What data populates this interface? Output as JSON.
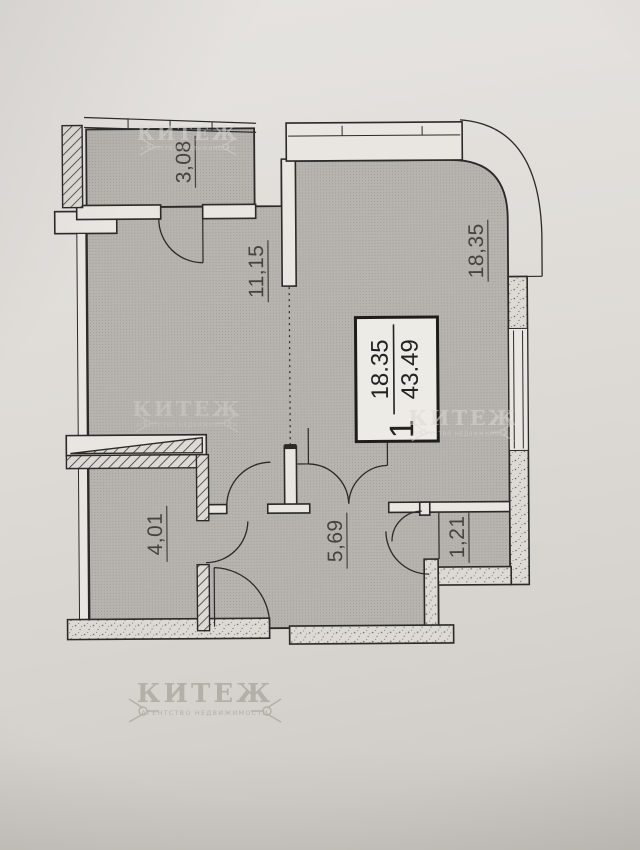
{
  "palette": {
    "paper": "#dedbd6",
    "room_fill": "#b7b3ae",
    "wall_fill": "#e9e6e1",
    "line": "#2a2a28",
    "label": "#45433f",
    "stamp_bg": "#edebe6",
    "watermark_light": "#dbd8d3",
    "watermark_dark": "#98948c"
  },
  "rooms": {
    "balcony": {
      "label": "3,08"
    },
    "living_left": {
      "label": "11,15"
    },
    "living_main": {
      "label": "18,35"
    },
    "bathroom": {
      "label": "4,01"
    },
    "hallway": {
      "label": "5,69"
    },
    "closet": {
      "label": "1,21"
    }
  },
  "stamp": {
    "room_count": "1",
    "living_area": "18.35",
    "total_area": "43.49"
  },
  "watermark": {
    "title": "КИТЕЖ",
    "subtitle": "АГЕНТСТВО НЕДВИЖИМОСТИ"
  }
}
